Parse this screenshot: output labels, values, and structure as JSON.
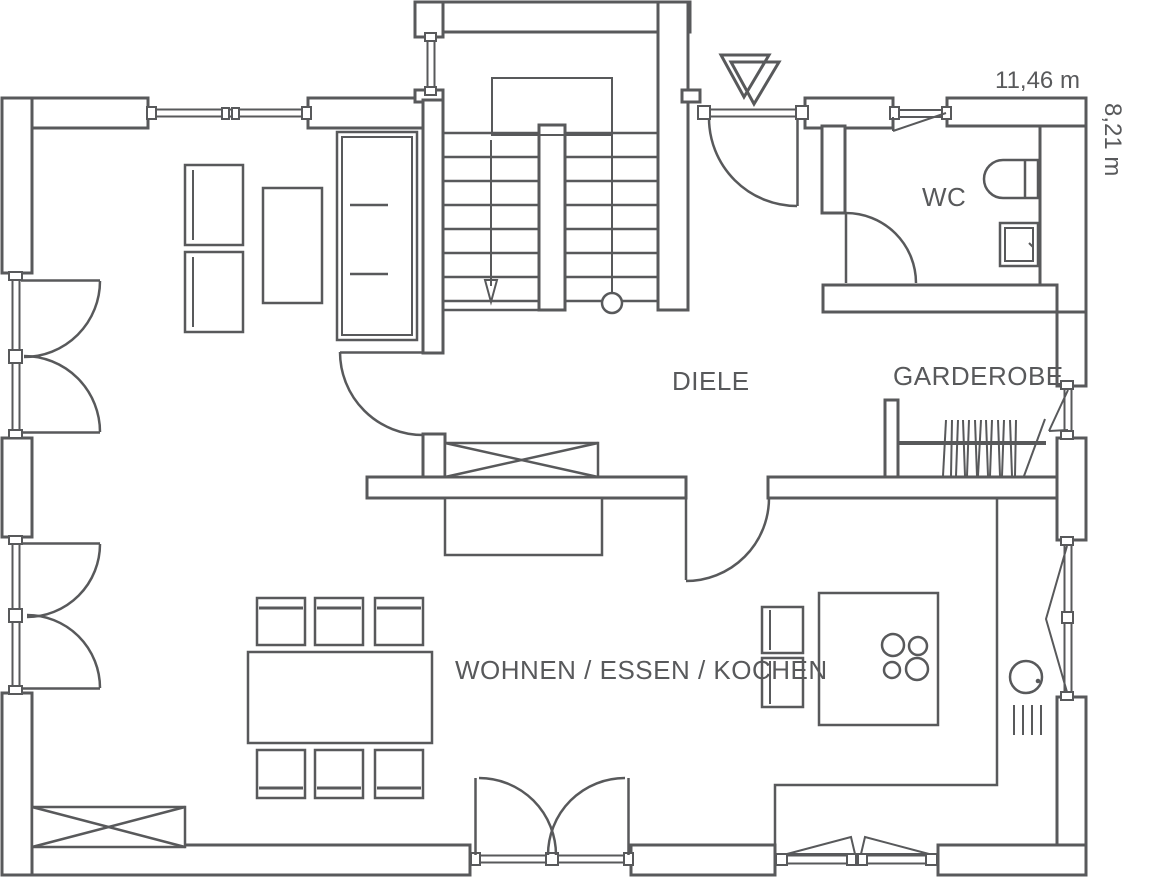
{
  "title": "floor-plan-ground-floor",
  "colors": {
    "line": "#58595b",
    "background": "#ffffff"
  },
  "rooms": {
    "wc": "WC",
    "hall": "DIELE",
    "wardrobe": "GARDEROBE",
    "living": "WOHNEN / ESSEN / KOCHEN"
  },
  "dimensions": {
    "width_label": "11,46 m",
    "height_label": "8,21 m"
  },
  "icons": {
    "entrance_marker": "double-triangle-icon",
    "stair_direction": "down-arrow-icon"
  }
}
